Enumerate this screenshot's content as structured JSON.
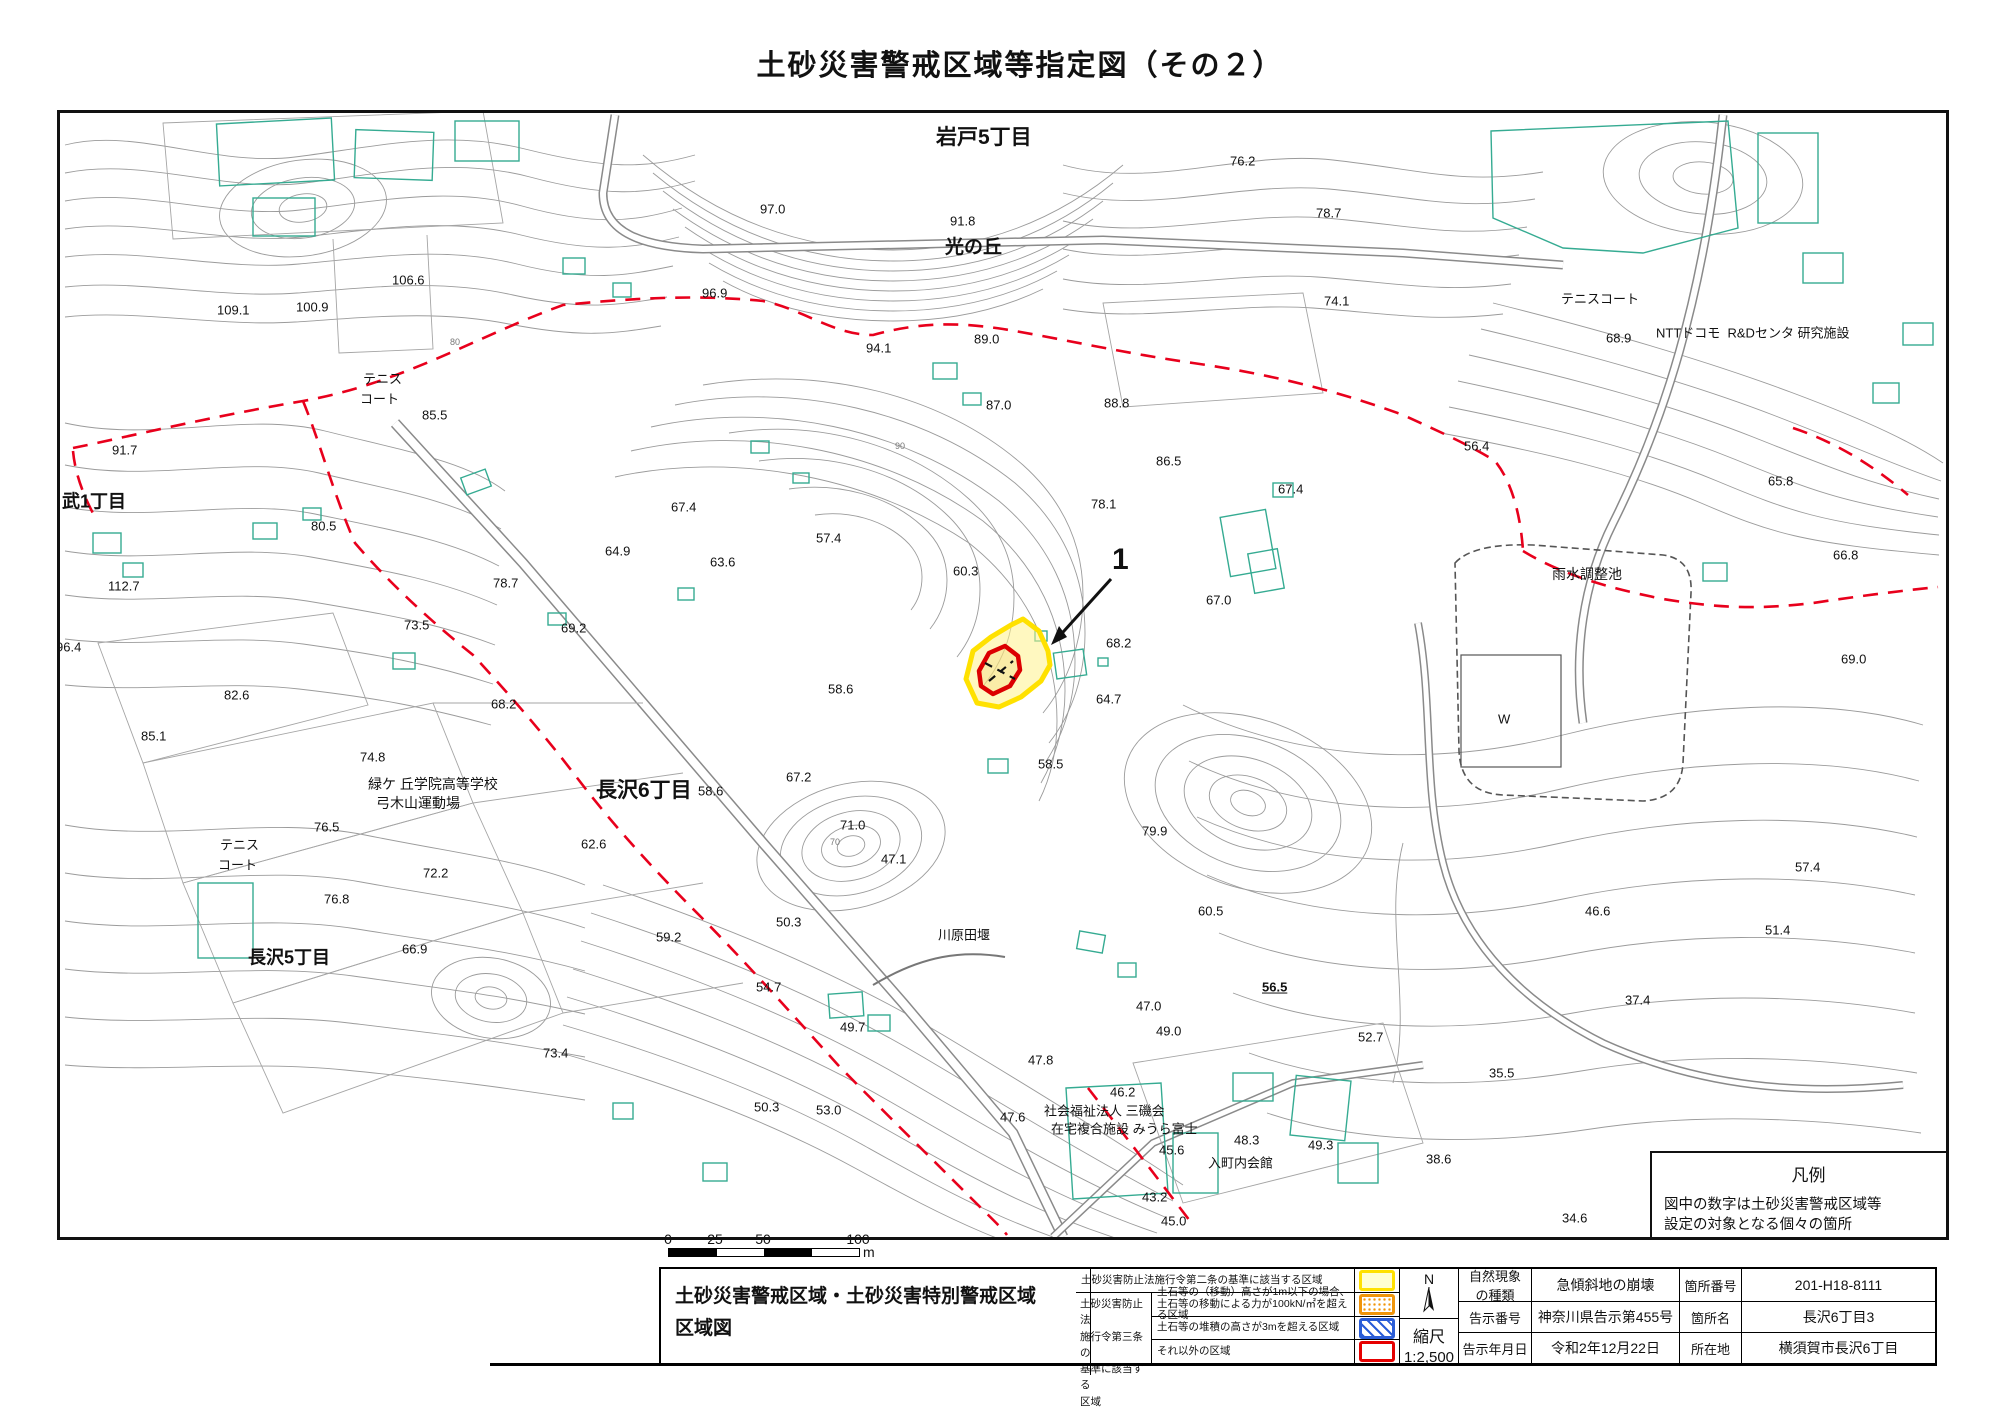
{
  "title": "土砂災害警戒区域等指定図（その２）",
  "colors": {
    "contour": "#9b9b9b",
    "building": "#35ab92",
    "boundary_dashed": "#e8001c",
    "zone_yellow": "#ffe100",
    "zone_red": "#dc0000",
    "legend_yellow": "#ffe100",
    "legend_orange": "#f0950a",
    "legend_blue": "#2b5dd7",
    "legend_red": "#e60000"
  },
  "map": {
    "marker_number": "1",
    "contour_note": "contour decoration only",
    "labels": [
      {
        "t": "岩戸5丁目",
        "x": 938,
        "y": 138,
        "fs": 21,
        "b": true,
        "n": "area-label-iwato5"
      },
      {
        "t": "光の丘",
        "x": 947,
        "y": 248,
        "fs": 19,
        "b": true,
        "n": "area-label-hikarinooka"
      },
      {
        "t": "武1丁目",
        "x": 64,
        "y": 502,
        "fs": 18,
        "b": true,
        "n": "area-label-takeshi1"
      },
      {
        "t": "長沢6丁目",
        "x": 598,
        "y": 791,
        "fs": 21,
        "b": true,
        "n": "area-label-nagasawa6"
      },
      {
        "t": "長沢5丁目",
        "x": 250,
        "y": 958,
        "fs": 18,
        "b": true,
        "n": "area-label-nagasawa5"
      },
      {
        "t": "テニス",
        "x": 365,
        "y": 380,
        "fs": 13
      },
      {
        "t": "コート",
        "x": 362,
        "y": 400,
        "fs": 13
      },
      {
        "t": "テニス",
        "x": 222,
        "y": 846,
        "fs": 13
      },
      {
        "t": "コート",
        "x": 220,
        "y": 866,
        "fs": 13
      },
      {
        "t": "テニスコート",
        "x": 1563,
        "y": 300,
        "fs": 13
      },
      {
        "t": "NTTドコモ  R&Dセンタ 研究施設",
        "x": 1658,
        "y": 334,
        "fs": 13
      },
      {
        "t": "雨水調整池",
        "x": 1554,
        "y": 574,
        "fs": 14
      },
      {
        "t": "W",
        "x": 1500,
        "y": 720,
        "fs": 13
      },
      {
        "t": "緑ケ 丘学院高等学校",
        "x": 370,
        "y": 784,
        "fs": 14
      },
      {
        "t": "弓木山運動場",
        "x": 378,
        "y": 803,
        "fs": 14
      },
      {
        "t": "川原田堰",
        "x": 940,
        "y": 936,
        "fs": 13
      },
      {
        "t": "社会福祉法人 三磯会",
        "x": 1046,
        "y": 1112,
        "fs": 13
      },
      {
        "t": "在宅複合施設 みうら富士",
        "x": 1053,
        "y": 1130,
        "fs": 13
      },
      {
        "t": "入町内会館",
        "x": 1210,
        "y": 1164,
        "fs": 13
      },
      {
        "t": "97.0",
        "x": 762,
        "y": 210
      },
      {
        "t": "91.8",
        "x": 952,
        "y": 222
      },
      {
        "t": "76.2",
        "x": 1232,
        "y": 162
      },
      {
        "t": "78.7",
        "x": 1318,
        "y": 214
      },
      {
        "t": "106.6",
        "x": 394,
        "y": 281
      },
      {
        "t": "96.9",
        "x": 704,
        "y": 294
      },
      {
        "t": "74.1",
        "x": 1326,
        "y": 302
      },
      {
        "t": "109.1",
        "x": 219,
        "y": 311
      },
      {
        "t": "100.9",
        "x": 298,
        "y": 308
      },
      {
        "t": "68.9",
        "x": 1608,
        "y": 339
      },
      {
        "t": "89.0",
        "x": 976,
        "y": 340
      },
      {
        "t": "94.1",
        "x": 868,
        "y": 349
      },
      {
        "t": "105.5",
        "x": 22,
        "y": 391
      },
      {
        "t": "85.5",
        "x": 424,
        "y": 416
      },
      {
        "t": "87.0",
        "x": 988,
        "y": 406
      },
      {
        "t": "88.8",
        "x": 1106,
        "y": 404
      },
      {
        "t": "91.7",
        "x": 114,
        "y": 451
      },
      {
        "t": "56.4",
        "x": 1466,
        "y": 447
      },
      {
        "t": "86.5",
        "x": 1158,
        "y": 462
      },
      {
        "t": "65.8",
        "x": 1770,
        "y": 482
      },
      {
        "t": "67.4",
        "x": 1280,
        "y": 490
      },
      {
        "t": "80.5",
        "x": 313,
        "y": 527
      },
      {
        "t": "67.4",
        "x": 673,
        "y": 508
      },
      {
        "t": "57.4",
        "x": 818,
        "y": 539
      },
      {
        "t": "78.1",
        "x": 1093,
        "y": 505
      },
      {
        "t": "64.9",
        "x": 607,
        "y": 552
      },
      {
        "t": "63.6",
        "x": 712,
        "y": 563
      },
      {
        "t": "112.7",
        "x": 110,
        "y": 587
      },
      {
        "t": "66.8",
        "x": 1835,
        "y": 556
      },
      {
        "t": "78.7",
        "x": 495,
        "y": 584
      },
      {
        "t": "60.3",
        "x": 955,
        "y": 572
      },
      {
        "t": "67.0",
        "x": 1208,
        "y": 601
      },
      {
        "t": "69.2",
        "x": 563,
        "y": 629
      },
      {
        "t": "73.5",
        "x": 406,
        "y": 626
      },
      {
        "t": "68.2",
        "x": 1108,
        "y": 644
      },
      {
        "t": "96.4",
        "x": 58,
        "y": 648
      },
      {
        "t": "69.0",
        "x": 1843,
        "y": 660
      },
      {
        "t": "58.6",
        "x": 830,
        "y": 690
      },
      {
        "t": "64.7",
        "x": 1098,
        "y": 700
      },
      {
        "t": "82.6",
        "x": 226,
        "y": 696
      },
      {
        "t": "68.2",
        "x": 493,
        "y": 705
      },
      {
        "t": "85.1",
        "x": 143,
        "y": 737
      },
      {
        "t": "58.5",
        "x": 1040,
        "y": 765
      },
      {
        "t": "74.8",
        "x": 362,
        "y": 758
      },
      {
        "t": "67.2",
        "x": 788,
        "y": 778
      },
      {
        "t": "58.6",
        "x": 700,
        "y": 792
      },
      {
        "t": "76.5",
        "x": 316,
        "y": 828
      },
      {
        "t": "71.0",
        "x": 842,
        "y": 826
      },
      {
        "t": "62.6",
        "x": 583,
        "y": 845
      },
      {
        "t": "72.2",
        "x": 425,
        "y": 874
      },
      {
        "t": "76.8",
        "x": 326,
        "y": 900
      },
      {
        "t": "47.1",
        "x": 883,
        "y": 860
      },
      {
        "t": "79.9",
        "x": 1144,
        "y": 832
      },
      {
        "t": "66.9",
        "x": 404,
        "y": 950
      },
      {
        "t": "50.3",
        "x": 778,
        "y": 923
      },
      {
        "t": "59.2",
        "x": 658,
        "y": 938
      },
      {
        "t": "60.5",
        "x": 1200,
        "y": 912
      },
      {
        "t": "56.5",
        "x": 1264,
        "y": 988,
        "b": true,
        "u": true
      },
      {
        "t": "52.7",
        "x": 1360,
        "y": 1038
      },
      {
        "t": "57.4",
        "x": 1797,
        "y": 868
      },
      {
        "t": "46.6",
        "x": 1587,
        "y": 912
      },
      {
        "t": "51.4",
        "x": 1767,
        "y": 931
      },
      {
        "t": "37.4",
        "x": 1627,
        "y": 1001
      },
      {
        "t": "35.5",
        "x": 1491,
        "y": 1074
      },
      {
        "t": "38.6",
        "x": 1428,
        "y": 1160
      },
      {
        "t": "54.7",
        "x": 758,
        "y": 988
      },
      {
        "t": "49.7",
        "x": 842,
        "y": 1028
      },
      {
        "t": "47.0",
        "x": 1138,
        "y": 1007
      },
      {
        "t": "49.0",
        "x": 1158,
        "y": 1032
      },
      {
        "t": "73.4",
        "x": 545,
        "y": 1054
      },
      {
        "t": "53.0",
        "x": 818,
        "y": 1111
      },
      {
        "t": "50.3",
        "x": 756,
        "y": 1108
      },
      {
        "t": "47.8",
        "x": 1030,
        "y": 1061
      },
      {
        "t": "47.6",
        "x": 1002,
        "y": 1118
      },
      {
        "t": "46.2",
        "x": 1112,
        "y": 1093
      },
      {
        "t": "45.6",
        "x": 1161,
        "y": 1151
      },
      {
        "t": "48.3",
        "x": 1236,
        "y": 1141
      },
      {
        "t": "49.3",
        "x": 1310,
        "y": 1146
      },
      {
        "t": "43.2",
        "x": 1144,
        "y": 1198
      },
      {
        "t": "45.0",
        "x": 1163,
        "y": 1222
      },
      {
        "t": "34.6",
        "x": 1564,
        "y": 1219
      },
      {
        "t": "39",
        "x": 1908,
        "y": 1204
      },
      {
        "t": "90",
        "x": 897,
        "y": 446,
        "fs": 9,
        "c": "#777"
      },
      {
        "t": "70",
        "x": 832,
        "y": 842,
        "fs": 9,
        "c": "#777"
      },
      {
        "t": "80",
        "x": 452,
        "y": 342,
        "fs": 9,
        "c": "#777"
      },
      {
        "t": "1",
        "x": 1114,
        "y": 560,
        "fs": 30,
        "b": true,
        "n": "zone-number-marker"
      }
    ],
    "hanrei": {
      "title": "凡例",
      "note_line1": "図中の数字は土砂災害警戒区域等",
      "note_line2": "設定の対象となる個々の箇所",
      "item_dashed": "字境界",
      "item_solid": "市区町村界"
    }
  },
  "scalebar": {
    "t0": "0",
    "t1": "25",
    "t2": "50",
    "t3": "100",
    "unit": "m"
  },
  "footer": {
    "sheet_title_line1": "土砂災害警戒区域・土砂災害特別警戒区域",
    "sheet_title_line2": "区域図",
    "legend": {
      "row1": "土砂災害防止法施行令第二条の基準に該当する区域",
      "group_label": "土砂災害防止法\n施行令第三条の\n基準に該当する\n区域",
      "row2_line1": "土石等の（移動）高さが1m以下の場合、",
      "row2_line2": "土石等の移動による力が100kN/㎡を超える区域",
      "row3": "土石等の堆積の高さが3mを超える区域",
      "row4": "それ以外の区域"
    },
    "compass": "N",
    "scale_label": "縮尺",
    "scale_value": "1:2,500",
    "info": {
      "rows": [
        {
          "label1": "自然現象\nの種類",
          "value1": "急傾斜地の崩壊",
          "label2": "箇所番号",
          "value2": "201-H18-8111"
        },
        {
          "label1": "告示番号",
          "value1": "神奈川県告示第455号",
          "label2": "箇所名",
          "value2": "長沢6丁目3"
        },
        {
          "label1": "告示年月日",
          "value1": "令和2年12月22日",
          "label2": "所在地",
          "value2": "横須賀市長沢6丁目"
        }
      ]
    }
  }
}
